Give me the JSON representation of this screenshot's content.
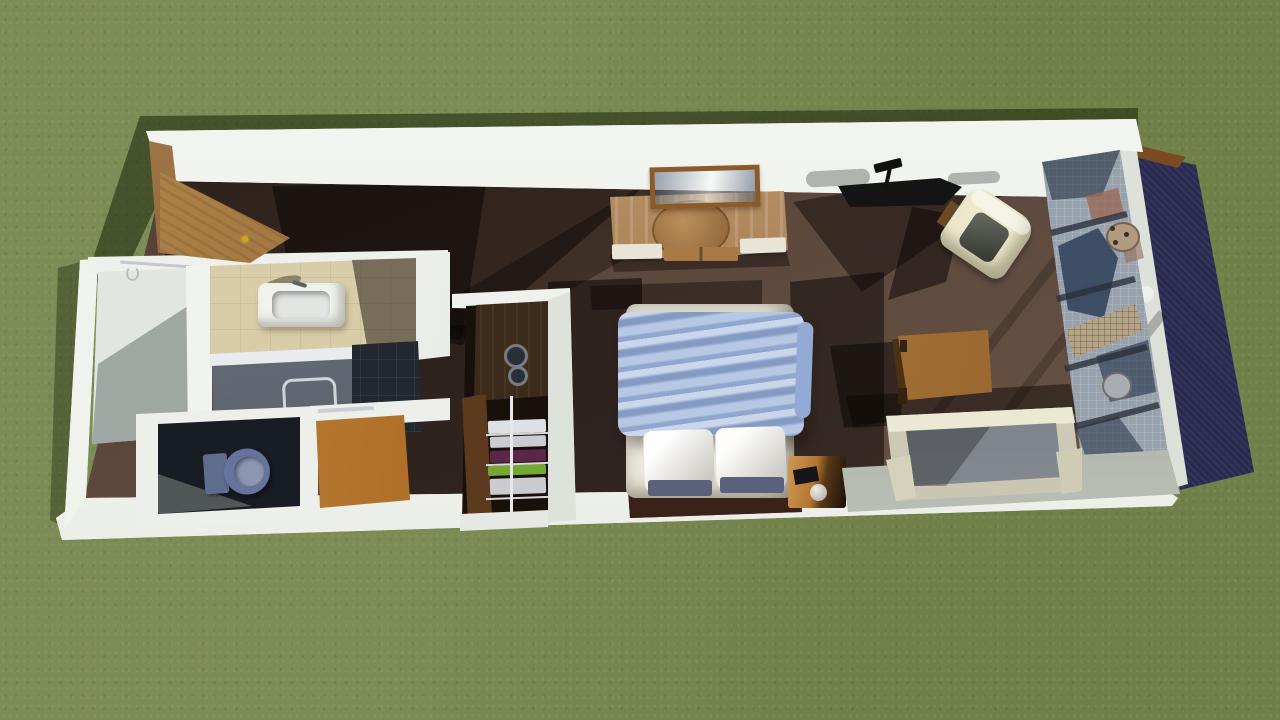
{
  "scene": {
    "description": "3D aerial render of a long narrow studio unit (entry, bathroom, wardrobe, bed, lounge) on a grass lawn with cast shadows",
    "view": "top-down oblique 3D render",
    "visible_text": []
  },
  "palette": {
    "grass": "#76854c",
    "grassShadow": "rgba(14,26,2,0.5)",
    "wall": "#eef0eb",
    "floor": "#5d4639",
    "chrome": "#ccd2d8"
  },
  "objects": {
    "lawn": {
      "label": "grass lawn"
    },
    "unitFloor": {
      "label": "dark brown unit floor",
      "color": "#5d4639"
    },
    "topWall": {
      "label": "top exterior wall"
    },
    "bottomWall": {
      "label": "bottom exterior wall"
    },
    "leftWall": {
      "label": "left exterior wall"
    },
    "entryDoor": {
      "label": "open wooden entry door",
      "color": "#8a5a28"
    },
    "entryPorch": {
      "label": "wooden entry porch",
      "color": "#996628"
    },
    "doorKnob": {
      "label": "gold door knob",
      "color": "#d4a418"
    },
    "walkInCloset": {
      "label": "walk-in closet with clothes rail",
      "floor": "#e2e6e0"
    },
    "bathroomFloor": {
      "label": "beige tiled bathroom floor",
      "color": "#d8cca9"
    },
    "sink": {
      "label": "white sink vanity",
      "color": "#f2f2ee"
    },
    "showerPanel": {
      "label": "grey shower panel with grab bar",
      "color": "#5f6774"
    },
    "showerTiles": {
      "label": "dark shower floor tiles",
      "color": "#23272f"
    },
    "toiletRoom": {
      "label": "toilet room"
    },
    "toilet": {
      "label": "blue-grey toilet",
      "color": "#66739c"
    },
    "storageCabinet": {
      "label": "wooden storage cabinet",
      "color": "#a8661f"
    },
    "wardrobe": {
      "label": "wardrobe niche with dials",
      "color": "#3c2b1b"
    },
    "shelves": {
      "label": "open shelves with folded clothes",
      "white": "#dfe0e4",
      "grey": "#caccd2",
      "purple": "#5a2746",
      "green": "#74a832"
    },
    "bed": {
      "label": "double bed",
      "mattress": "#e9e6da",
      "base": "#3a2218"
    },
    "blanket": {
      "label": "light blue duvet",
      "color": "#a9bedf"
    },
    "pillowLeft": {
      "label": "white pillow",
      "color": "#f0eee6"
    },
    "pillowRight": {
      "label": "white pillow",
      "color": "#f0eee6"
    },
    "nightstand": {
      "label": "bedside chest with ball lamp",
      "color": "#b5762f"
    },
    "console": {
      "label": "wooden media console with tucked chair",
      "color": "#a97a46"
    },
    "picture": {
      "label": "framed picture on wall",
      "frame": "#8a5a2a",
      "image": "#9fb0c8"
    },
    "blackDesk": {
      "label": "black desk with lamp",
      "color": "#141414"
    },
    "armchair": {
      "label": "cream armchair",
      "color": "#ece9cd",
      "seat": "#4e5247"
    },
    "workTable": {
      "label": "wooden work table",
      "color": "#b4762f"
    },
    "sofa": {
      "label": "cream sofa with grey cushions",
      "frame": "#dcd9c3",
      "cushion": "#7d848b"
    },
    "platform": {
      "label": "grey floor platform",
      "color": "#b3b9ae"
    },
    "mosaicWall": {
      "label": "blue-grey mosaic feature wall",
      "color": "#97a2ad",
      "accentTan": "#b5a487"
    },
    "endTrim": {
      "label": "white end wall trim"
    },
    "navyPanel": {
      "label": "navy exterior panel",
      "color": "#3c3c6e"
    },
    "woodEdge": {
      "label": "wooden roof edge",
      "color": "#7a4a22"
    }
  }
}
